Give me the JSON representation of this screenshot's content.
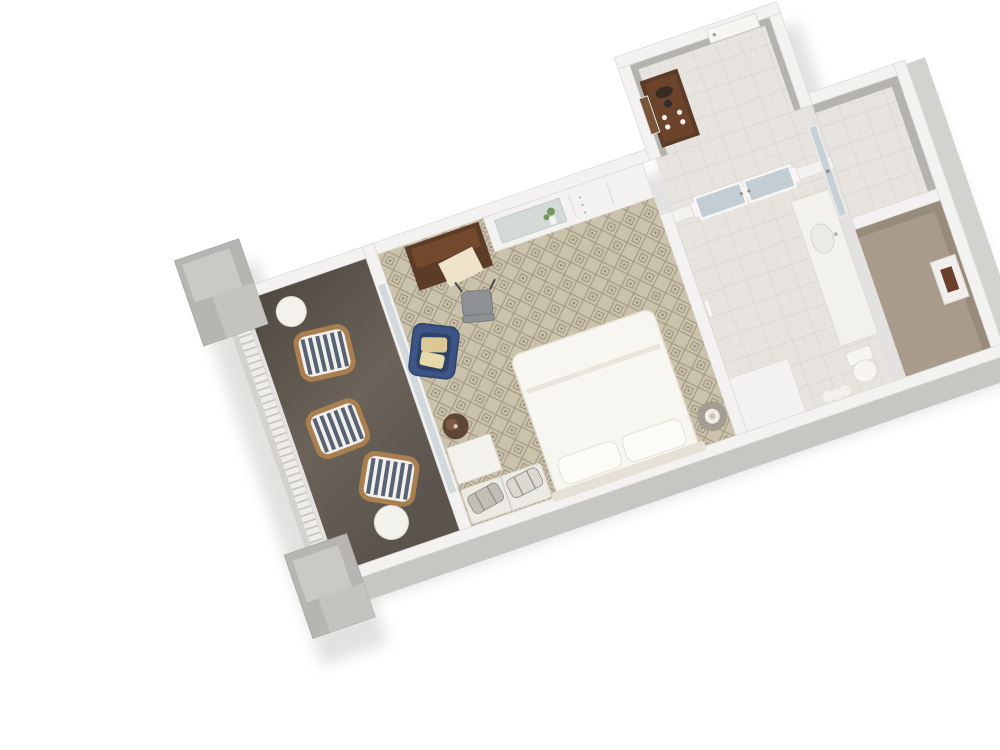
{
  "scene": {
    "description": "3D isometric rendering of a hotel guest room floor plan with balcony, bedroom, entry hall, bathroom, shower and closet",
    "background": "#ffffff",
    "rotation_deg": -19,
    "view": "top-down cutaway dollhouse view"
  },
  "palette": {
    "background": "#ffffff",
    "wall_top": "#f3f2f0",
    "wall_edge": "#dddbd8",
    "wall_side": "#c7c6c3",
    "wall_side_light": "#d3d2cf",
    "slab_gray": "#aaa8a5",
    "shadow": "#e3e2e0",
    "carpet_base": "#cbc2ac",
    "carpet_line": "#a89e87",
    "carpet_motif": "#9b9179",
    "balcony_floor": "#655d55",
    "balcony_floor_dark": "#4e4841",
    "railing_white": "#efedea",
    "railing_slat": "#c9c6c1",
    "block_gray": "#b7b5b2",
    "block_gray_light": "#cbc9c6",
    "wood_dark": "#5c3b27",
    "wood_panel": "#73492e",
    "paper": "#efe3cb",
    "chair_blue": "#3d5584",
    "chair_blue_dark": "#2f4268",
    "pillow_tan": "#dcc894",
    "pillow_tan2": "#e8d9ab",
    "desk_gray": "#8e9193",
    "desk_gray_dark": "#75787a",
    "bed_white": "#f8f6f1",
    "bed_edge": "#e5e1d7",
    "pillow_white": "#fcfbf8",
    "nightstand": "#a39c92",
    "lamp_base": "#efece5",
    "lamp_inner": "#c9c1b5",
    "stripe_blue": "#576372",
    "stripe_white": "#f1f0ec",
    "frame_tan": "#aa7f4f",
    "table_white": "#f3f1ec",
    "ottoman": "#5e4634",
    "ottoman_hi": "#7b5b44",
    "bench": "#eceae4",
    "suitcase_a": "#c2beb6",
    "suitcase_b": "#dcd8d1",
    "strap": "#8e8a82",
    "tile_base": "#e7e4df",
    "tile_line": "#d5d1ca",
    "tile_shower": "#dfdcd6",
    "glass": "#c2ced3",
    "glass_frame": "#f7f6f4",
    "mirror": "#d4dad6",
    "green": "#72985f",
    "closet_floor": "#a89b8c",
    "closet_wall": "#978b7c",
    "hall_wallpaper": "#b5b3af",
    "safe_face": "#f1efec",
    "safe_brown": "#6b3f2a",
    "vanity": "#f3f1ed",
    "vanity_edge": "#ded9d1",
    "door_white": "#f6f5f2",
    "picture_brown": "#7a5638"
  },
  "rooms": [
    {
      "id": "balcony",
      "label": "balcony",
      "floor": "dark taupe decking"
    },
    {
      "id": "bedroom",
      "label": "bedroom",
      "floor": "beige diamond-pattern carpet"
    },
    {
      "id": "entry_hall",
      "label": "entry hall",
      "floor": "light tile"
    },
    {
      "id": "bathroom",
      "label": "bathroom",
      "floor": "light tile"
    },
    {
      "id": "shower",
      "label": "shower stall",
      "floor": "light tile"
    },
    {
      "id": "closet",
      "label": "closet",
      "floor": "tan carpet"
    }
  ],
  "furniture": {
    "balcony": [
      "striped lounge chair",
      "striped lounge chair",
      "striped lounge chair",
      "round side table",
      "round side table"
    ],
    "bedroom": [
      "king bed with white duvet",
      "round nightstand with lamp",
      "round nightstand with lamp",
      "dark wood armoire desk",
      "gray desk chair",
      "blue armchair with two tan pillows",
      "built-in white console with mirrored niche and greenery",
      "luggage bench with two suitcases",
      "white side table",
      "round dark ottoman"
    ],
    "entry_hall": [
      "dark wood coffee credenza with cups and kettle",
      "framed wall picture",
      "entry door"
    ],
    "bathroom": [
      "double frosted glass doors",
      "white vanity with sink",
      "toilet",
      "wall jog",
      "bath mat"
    ],
    "shower": [
      "glass shower panel"
    ],
    "closet": [
      "wall safe"
    ]
  }
}
